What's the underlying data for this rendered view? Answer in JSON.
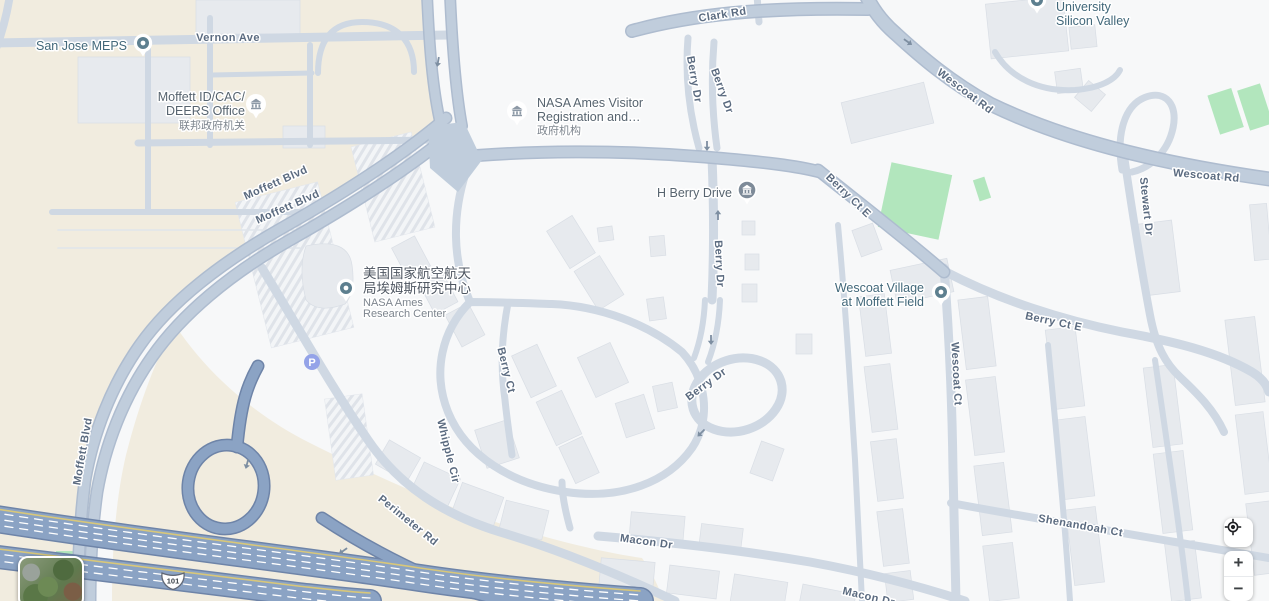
{
  "colors": {
    "background": "#f7f8f9",
    "federal_land": "#f1ecdf",
    "road_minor": "#cfd8e3",
    "road_arterial": "#c0cddc",
    "highway_fill": "#8ba3c4",
    "highway_casing": "#6e84a8",
    "green_area": "#b2e6bd",
    "building": "#e7eaee",
    "road_label_text": "#5b6b80",
    "poi_teal_text": "#42687a",
    "marker_fill": "#5d7f8f",
    "parking_icon": "#94a3e8"
  },
  "road_labels": [
    {
      "text": "Vernon Ave"
    },
    {
      "text": "Moffett Blvd"
    },
    {
      "text": "Moffett Blvd"
    },
    {
      "text": "Moffett Blvd"
    },
    {
      "text": "Clark Rd"
    },
    {
      "text": "Wescoat Rd"
    },
    {
      "text": "Wescoat Rd"
    },
    {
      "text": "Berry Dr"
    },
    {
      "text": "Berry Dr"
    },
    {
      "text": "Berry Dr"
    },
    {
      "text": "Berry Dr"
    },
    {
      "text": "Berry Ct E"
    },
    {
      "text": "Berry Ct E"
    },
    {
      "text": "Stewart Dr"
    },
    {
      "text": "Wescoat Ct"
    },
    {
      "text": "Berry Ct"
    },
    {
      "text": "Whipple Cir"
    },
    {
      "text": "Perimeter Rd"
    },
    {
      "text": "Macon Dr"
    },
    {
      "text": "Macon Dr"
    },
    {
      "text": "Shenandoah Ct"
    }
  ],
  "pois": [
    {
      "name": "San Jose MEPS",
      "lines": [
        "San Jose MEPS"
      ]
    },
    {
      "name": "Moffett ID/CAC/DEERS Office",
      "lines": [
        "Moffett ID/CAC/",
        "DEERS Office",
        "联邦政府机关"
      ]
    },
    {
      "name": "NASA Ames Visitor Registration",
      "lines": [
        "NASA Ames Visitor",
        "Registration and…",
        "政府机构"
      ]
    },
    {
      "name": "H Berry Drive",
      "lines": [
        "H Berry Drive"
      ]
    },
    {
      "name": "NASA Ames Research Center",
      "lines": [
        "美国国家航空航天",
        "局埃姆斯研究中心",
        "NASA Ames",
        "Research Center"
      ]
    },
    {
      "name": "Wescoat Village at Moffett Field",
      "lines": [
        "Wescoat Village",
        "at Moffett Field"
      ]
    },
    {
      "name": "University Silicon Valley",
      "lines": [
        "University",
        "Silicon Valley"
      ]
    }
  ],
  "parking": {
    "label": "P"
  },
  "highway_shield": {
    "route": "101"
  },
  "controls": {
    "zoom_in": "+",
    "zoom_out": "−"
  }
}
